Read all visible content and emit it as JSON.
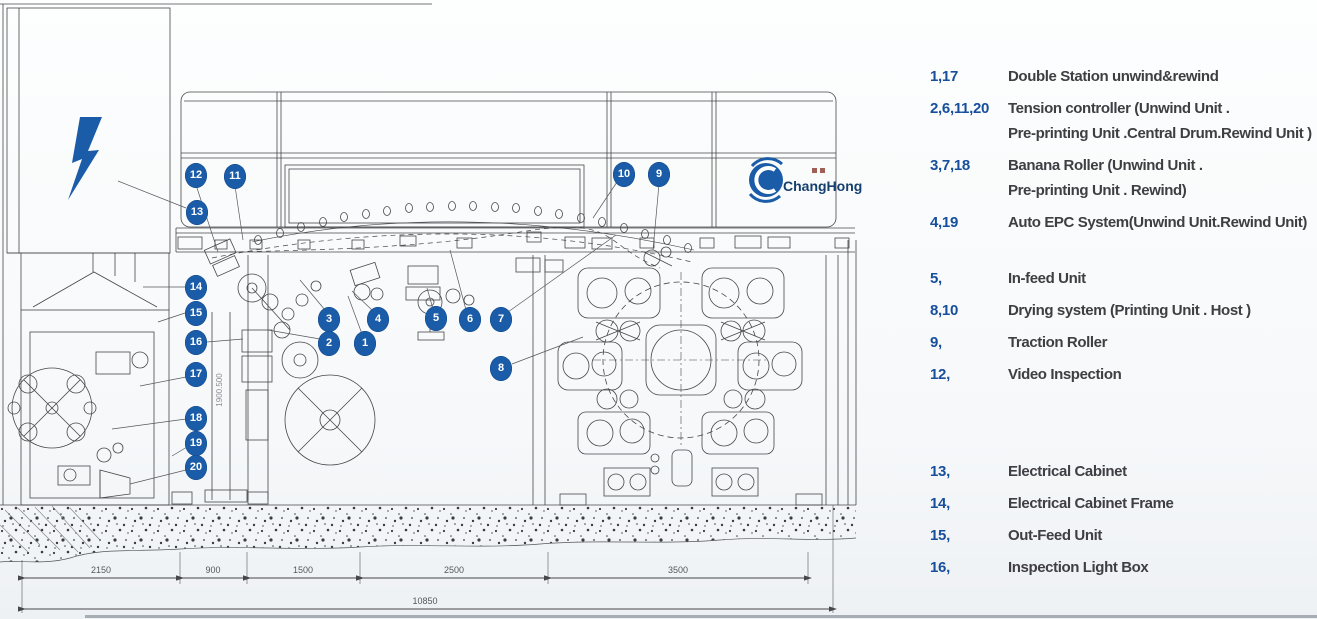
{
  "page": {
    "background": "#f7f9fb"
  },
  "logo": {
    "name": "ChangHong"
  },
  "colors": {
    "accent_blue": "#1b5ca8",
    "legend_number_blue": "#174f9c",
    "legend_text_gray": "#3e3e43",
    "line_gray": "#45474b"
  },
  "legend": {
    "groups": [
      {
        "rows": [
          {
            "nums": "1,17",
            "lines": [
              "Double Station unwind&rewind"
            ]
          },
          {
            "nums": "2,6,11,20",
            "lines": [
              "Tension controller (Unwind Unit .",
              "Pre-printing Unit .Central Drum.Rewind Unit )"
            ]
          },
          {
            "nums": "3,7,18",
            "lines": [
              "Banana Roller (Unwind Unit .",
              "Pre-printing Unit . Rewind)"
            ]
          },
          {
            "nums": "4,19",
            "lines": [
              "Auto EPC System(Unwind Unit.Rewind Unit)"
            ]
          }
        ]
      },
      {
        "rows": [
          {
            "nums": "5,",
            "lines": [
              "In-feed Unit"
            ]
          },
          {
            "nums": "8,10",
            "lines": [
              "Drying system (Printing Unit . Host )"
            ]
          },
          {
            "nums": "9,",
            "lines": [
              "Traction Roller"
            ]
          },
          {
            "nums": "12,",
            "lines": [
              "Video Inspection"
            ]
          }
        ]
      },
      {
        "rows": [
          {
            "nums": "13,",
            "lines": [
              "Electrical Cabinet"
            ]
          },
          {
            "nums": "14,",
            "lines": [
              "Electrical Cabinet Frame"
            ]
          },
          {
            "nums": "15,",
            "lines": [
              "Out-Feed Unit"
            ]
          },
          {
            "nums": "16,",
            "lines": [
              "Inspection Light Box"
            ]
          }
        ]
      }
    ]
  },
  "diagram": {
    "callouts": [
      {
        "n": "1",
        "x": 365,
        "y": 343
      },
      {
        "n": "2",
        "x": 329,
        "y": 343
      },
      {
        "n": "3",
        "x": 329,
        "y": 319
      },
      {
        "n": "4",
        "x": 378,
        "y": 319
      },
      {
        "n": "5",
        "x": 436,
        "y": 318
      },
      {
        "n": "6",
        "x": 470,
        "y": 319
      },
      {
        "n": "7",
        "x": 501,
        "y": 319
      },
      {
        "n": "8",
        "x": 501,
        "y": 368
      },
      {
        "n": "9",
        "x": 659,
        "y": 174
      },
      {
        "n": "10",
        "x": 624,
        "y": 174
      },
      {
        "n": "11",
        "x": 235,
        "y": 176
      },
      {
        "n": "12",
        "x": 196,
        "y": 175
      },
      {
        "n": "13",
        "x": 197,
        "y": 212
      },
      {
        "n": "14",
        "x": 196,
        "y": 287
      },
      {
        "n": "15",
        "x": 196,
        "y": 313
      },
      {
        "n": "16",
        "x": 196,
        "y": 342
      },
      {
        "n": "17",
        "x": 196,
        "y": 374
      },
      {
        "n": "18",
        "x": 196,
        "y": 418
      },
      {
        "n": "19",
        "x": 196,
        "y": 443
      },
      {
        "n": "20",
        "x": 196,
        "y": 467
      }
    ],
    "dimensions": {
      "segments": [
        "2150",
        "900",
        "1500",
        "2500",
        "3500"
      ],
      "total": "10850",
      "vertical": "1900.500"
    }
  }
}
